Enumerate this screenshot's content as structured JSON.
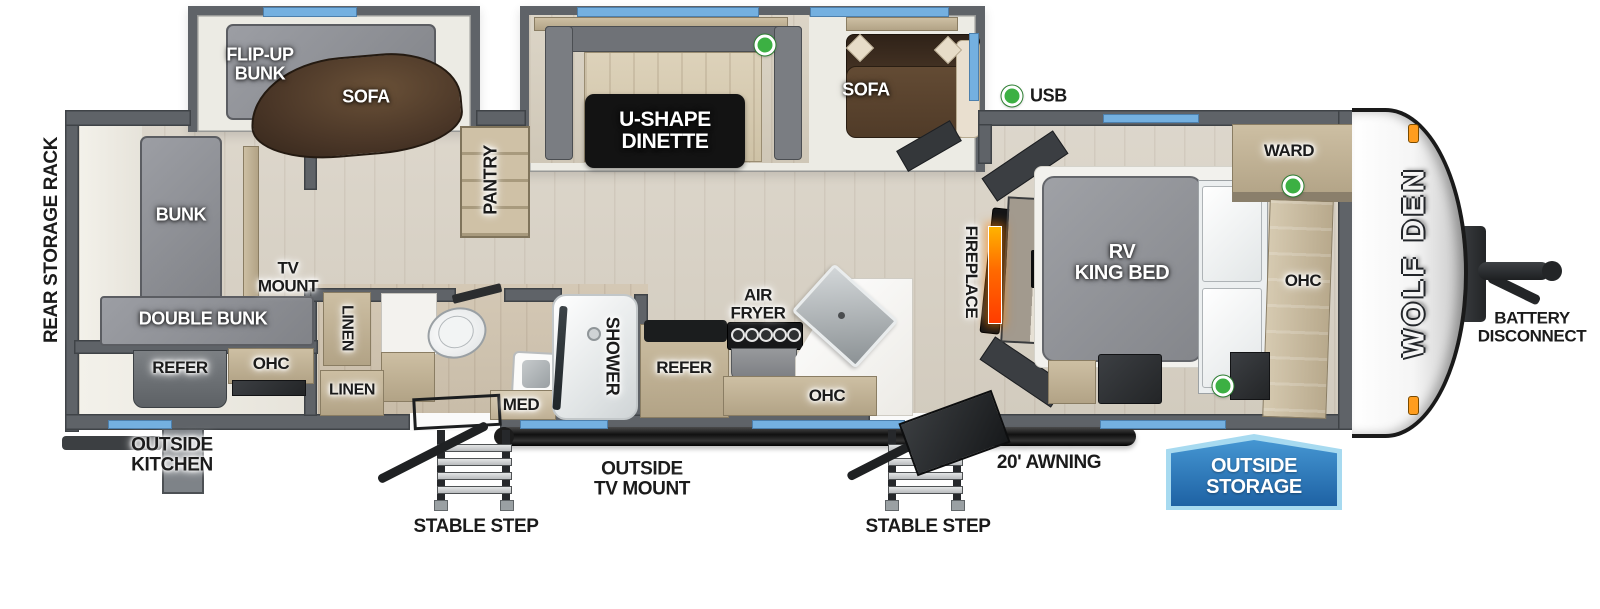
{
  "title": "Wolf Den travel trailer floorplan",
  "colors": {
    "wall": "#5f6368",
    "wall_dark": "#3f4347",
    "window_blue": "#74b0e0",
    "sofa_brown": "#54402e",
    "mattress_gray": "#8f9196",
    "wood_cabinet": "#c0b298",
    "accent_green": "#3cb043",
    "badge_blue": "#2470b0",
    "badge_border": "#a7daf0",
    "fire_orange": "#ff7a00",
    "label_dark": "#1b1b1b"
  },
  "legend": {
    "usb_label": "USB"
  },
  "rooms": {
    "rear_bunk_room": {
      "rear_storage_rack": "REAR STORAGE RACK",
      "bunk": "BUNK",
      "tv_mount": [
        "TV",
        "MOUNT"
      ],
      "double_bunk": "DOUBLE BUNK",
      "refer": "REFER",
      "ohc": "OHC"
    },
    "flip_up_bunk_slide": {
      "flip_up_bunk": [
        "FLIP-UP",
        "BUNK"
      ],
      "sofa": "SOFA"
    },
    "dinette_slide": {
      "dinette": [
        "U-SHAPE",
        "DINETTE"
      ],
      "sofa": "SOFA"
    },
    "hall": {
      "pantry": "PANTRY"
    },
    "bathroom": {
      "linen_upper": "LINEN",
      "linen_lower": "LINEN",
      "med": "MED",
      "shower": "SHOWER"
    },
    "kitchen": {
      "refer": "REFER",
      "air_fryer": [
        "AIR",
        "FRYER"
      ],
      "ohc": "OHC"
    },
    "living": {
      "fireplace": "FIREPLACE"
    },
    "bedroom": {
      "ward": "WARD",
      "bed": [
        "RV",
        "KING BED"
      ],
      "ohc": "OHC"
    }
  },
  "exterior": {
    "wolf_den_logo": "WOLF DEN",
    "battery_disconnect": [
      "BATTERY",
      "DISCONNECT"
    ],
    "outside_kitchen": [
      "OUTSIDE",
      "KITCHEN"
    ],
    "outside_tv_mount": [
      "OUTSIDE",
      "TV MOUNT"
    ],
    "stable_step_left": "STABLE STEP",
    "stable_step_right": "STABLE STEP",
    "awning": "20' AWNING",
    "outside_storage": [
      "OUTSIDE",
      "STORAGE"
    ]
  }
}
